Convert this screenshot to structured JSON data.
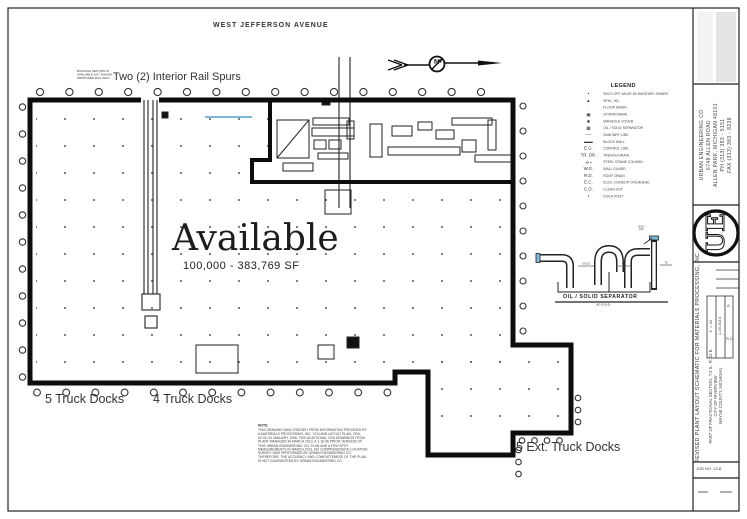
{
  "plan": {
    "street_label": "WEST JEFFERSON AVENUE",
    "rail_spurs_label": "Two (2) Interior Rail Spurs",
    "rail_spurs_note": "BUILDING SECTION IS\nAVAILABLE NOT SHOWN\nPROPOSED RAIL WALL",
    "north_label": "N",
    "available_title": "Available",
    "available_size": "100,000 - 383,769 SF",
    "dock_label_left": "5 Truck Docks",
    "dock_label_mid": "4 Truck Docks",
    "dock_label_ext": "5 Ext. Truck Docks"
  },
  "legend": {
    "title": "LEGEND",
    "items": [
      {
        "symbol": "•",
        "label": "SHUT-OFF VALVE W/ SANITARY SEWER"
      },
      {
        "symbol": "▲",
        "label": "SPKL. HD."
      },
      {
        "symbol": "·",
        "label": "FLOOR DRAIN"
      },
      {
        "symbol": "▣",
        "label": "STORM DRAIN"
      },
      {
        "symbol": "✸",
        "label": "MANHOLE COVER"
      },
      {
        "symbol": "▦",
        "label": "OIL / SOLID SEPARATOR"
      },
      {
        "symbol": "──",
        "label": "SANITARY LINE"
      },
      {
        "symbol": "▬▬",
        "label": "BLOCK WALL"
      },
      {
        "symbol": "E.G.",
        "label": "CONTROL LINE"
      },
      {
        "symbol": "TR. DR.",
        "label": "TRENCH DRAIN"
      },
      {
        "symbol": "✛ ▪",
        "label": "STEEL CRANE COLUMN"
      },
      {
        "symbol": "W.G.",
        "label": "WALL GUARD"
      },
      {
        "symbol": "R.D.",
        "label": "ROOF DRAIN"
      },
      {
        "symbol": "E.C.",
        "label": "ELEC. CONDUIT OVERHEAD"
      },
      {
        "symbol": "C.O.",
        "label": "CLEAN OUT"
      },
      {
        "symbol": "▪",
        "label": "DOCK POST"
      }
    ]
  },
  "separator": {
    "title": "OIL / SOLID SEPARATOR",
    "scale_note": "(NO SCALE)",
    "label_solid": "SOLID\nCOLLECTION",
    "label_oil": "OIL\nCOLLECTION",
    "label_shut": "SHUT\nOFF",
    "label_sanitary": "TO\nSANITARY"
  },
  "note": {
    "title": "NOTE:",
    "lines": [
      "THIS DRAWING WAS CREATED FROM INFORMATION PROVIDED BY",
      "A MATERIALS PROCESSING, INC. COLUMN LAYOUT PLAN, CRA-",
      "92-90, IN JANUARY 1996, TWO ADDITIONAL CRA DRAWINGS FROM",
      "PLANT MANAGER IN MARCH 2013, A 1-16-96 PRIOR VERSION OF",
      "THIS URBAN ENGINEERING CO. PLAN AND A FEW SPOT",
      "MEASUREMENTS IN MARCH 2013. NO COMPREHENSIVE LOCATION",
      "SURVEY WAS PERFORMED BY URBAN ENGINEERING CO.",
      "THEREFORE, THE ACCURACY AND COMPLETENESS OF THE PLAN",
      "IS NOT GUARANTEED BY URBAN ENGINEERING CO."
    ]
  },
  "titleblock": {
    "company_lines": [
      "URBAN ENGINEERING CO",
      "6748 ALLEN ROAD",
      "ALLEN PARK, MICHIGAN 48101",
      "PH (313) 383 - 5151",
      "FAX (313) 383 - 8238"
    ],
    "logo_text": "UE",
    "drawing_title": "REVISED PLANT LAYOUT SCHEMATIC FOR MATERIALS PROCESSING, INC.",
    "location_lines": [
      "PART OF FRACTIONAL SECTION, T.4 S., R. 11 E.",
      "CITY OF RIVERVIEW",
      "WAYNE COUNTY, MICHIGAN"
    ],
    "scale": "1\" = 40'",
    "date": "1-29-2013",
    "rev": "A",
    "by": "R.C.",
    "job": "JOB NO. 13-B"
  },
  "colors": {
    "line": "#111111",
    "wall": "#0d0d0d",
    "accent_blue": "#7fb8d8"
  }
}
